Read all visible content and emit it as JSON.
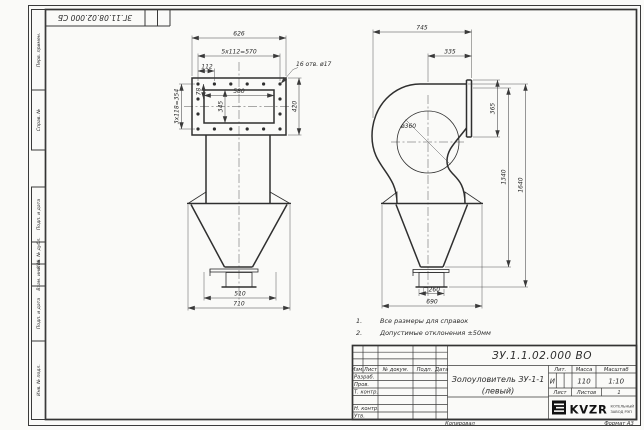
{
  "sheet": {
    "corner_designation": "ЗГ.11.08.02.000 СБ",
    "copied_label": "Копировал",
    "format_label": "Формат А3"
  },
  "stamp_column": [
    "Перв. примен.",
    "Справ. №",
    "Подп. и дата",
    "Инв. № дубл.",
    "Взам. инв. №",
    "Подп. и дата",
    "Инв. № подл."
  ],
  "notes": [
    {
      "num": "1.",
      "text": "Все размеры для справок"
    },
    {
      "num": "2.",
      "text": "Допустимые отклонения ±50мм"
    }
  ],
  "front_view": {
    "dims": {
      "overall_width": "626",
      "bolt_spacing_top": "5х112=570",
      "bolt_pitch": "112",
      "edge_offset": "78",
      "inner_width": "580",
      "inner_height": "345",
      "bolt_spacing_side": "3х118=354",
      "flange_height": "420",
      "holes_note": "16 отв. ø17",
      "outlet_width": "510",
      "base_width": "710"
    }
  },
  "side_view": {
    "dims": {
      "overall_width": "745",
      "outlet_length": "335",
      "flange_height": "365",
      "body_diameter": "ø360",
      "cone_height": "1340",
      "overall_height": "1640",
      "outlet_square": "□260",
      "base_width": "690"
    }
  },
  "title_block": {
    "designation": "ЗУ.1.1.02.000 ВО",
    "product_name": "Золоуловитель ЗУ-1-1",
    "product_variant": "(левый)",
    "columns": [
      "Изм.",
      "Лист",
      "№ докум.",
      "Подп.",
      "Дата"
    ],
    "roles": [
      "Разраб.",
      "Пров.",
      "Т. контр.",
      "Н. контр.",
      "Утв."
    ],
    "lit_label": "Лит.",
    "lit_value": "И",
    "mass_label": "Масса",
    "mass_value": "110",
    "scale_label": "Масштаб",
    "scale_value": "1:10",
    "sheet_label": "Лист",
    "sheets_label": "Листов",
    "sheets_value": "1",
    "logo_text": "KVZR",
    "logo_sub_line1": "КОТЕЛЬНЫЙ",
    "logo_sub_line2": "ЗАВОД РЭП"
  }
}
